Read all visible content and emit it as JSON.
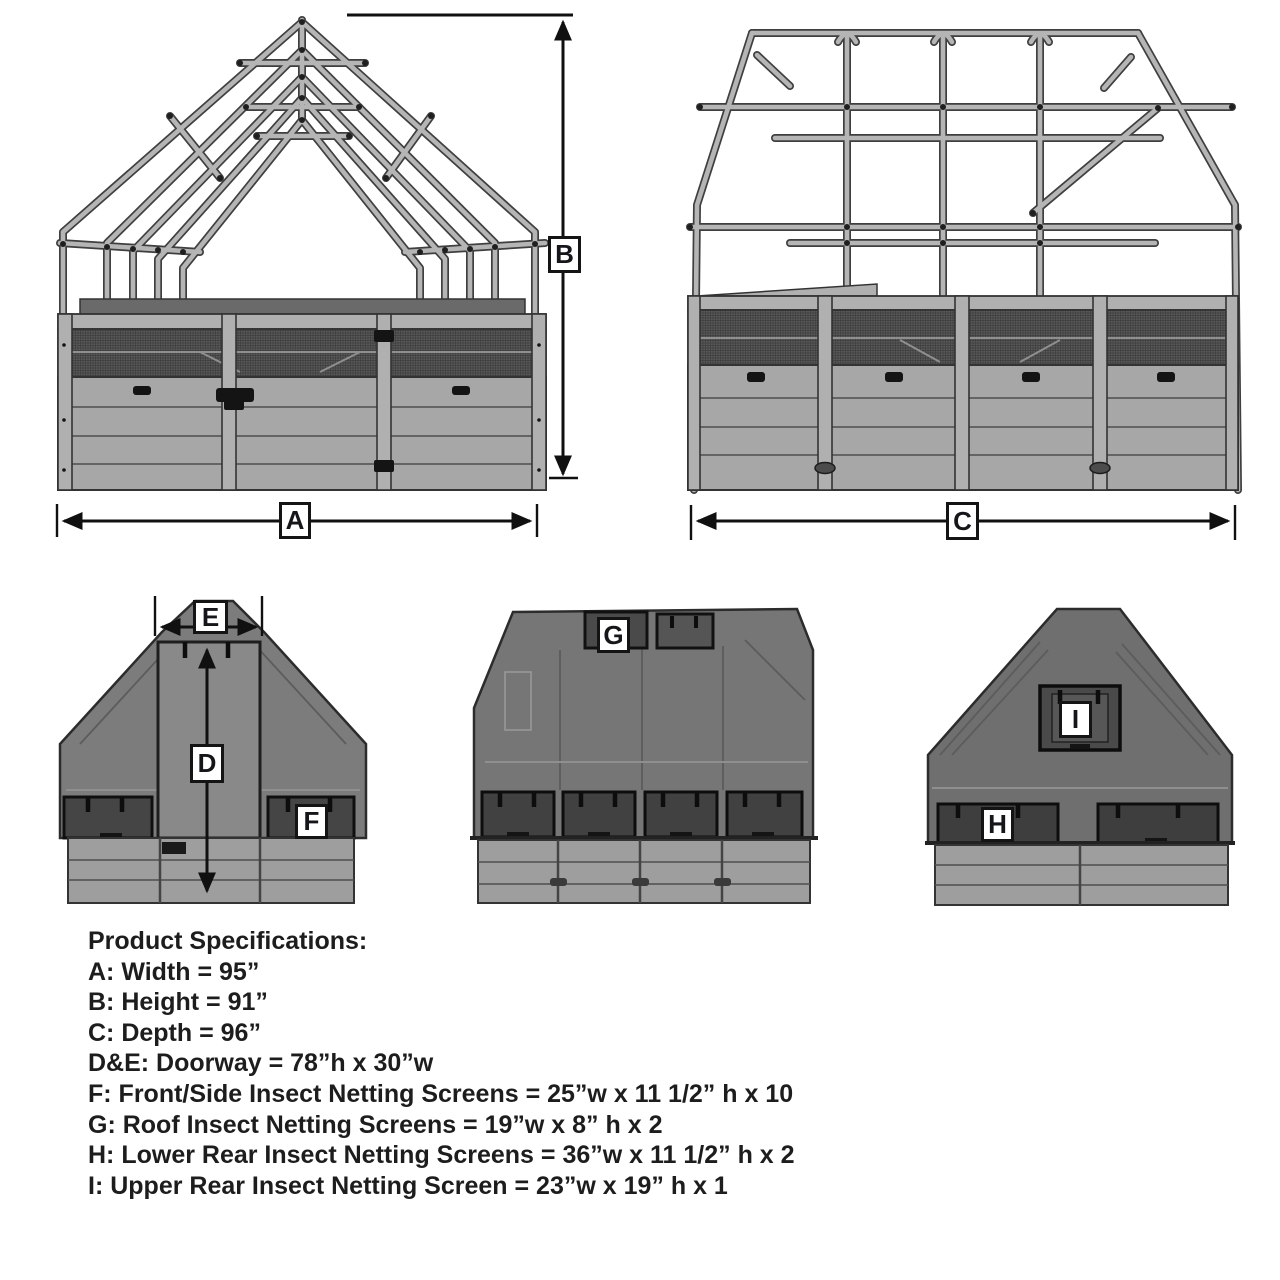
{
  "dimension_labels": {
    "a": "A",
    "b": "B",
    "c": "C",
    "d": "D",
    "e": "E",
    "f": "F",
    "g": "G",
    "h": "H",
    "i": "I"
  },
  "specs": {
    "title": "Product Specifications:",
    "lines": [
      "A: Width = 95”",
      "B: Height = 91”",
      "C: Depth = 96”",
      "D&E: Doorway = 78”h x 30”w",
      "F: Front/Side Insect Netting Screens = 25”w x 11 1/2” h x 10",
      "G: Roof Insect Netting Screens = 19”w x 8” h x 2",
      "H: Lower Rear Insect Netting Screens = 36”w x 11 1/2” h x 2",
      "I: Upper Rear Insect Netting Screen = 23”w x 19” h x 1"
    ]
  },
  "colors": {
    "line": "#101010",
    "tube_outline": "#3f3f3f",
    "tube_fill": "#b5b5b5",
    "mesh": "#5a5a5a",
    "panel": "#a7a7a7",
    "netting_cover": "#767676",
    "screen": "#424242"
  }
}
